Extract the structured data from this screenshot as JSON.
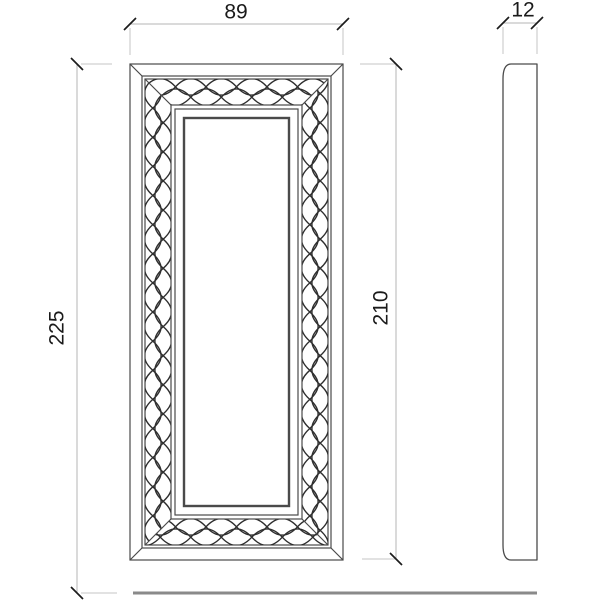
{
  "drawing": {
    "dimensions": {
      "width": "89",
      "depth": "12",
      "overall_height": "225",
      "frame_height": "210"
    },
    "colors": {
      "background": "#ffffff",
      "line": "#4a4a4a",
      "lattice": "#2e2e2e",
      "dim_line": "#b5b5b5",
      "ext_line": "#c6c6c6",
      "tick": "#1c1c1c",
      "floor": "#8a8a8a",
      "text": "#1a1a1a"
    }
  }
}
